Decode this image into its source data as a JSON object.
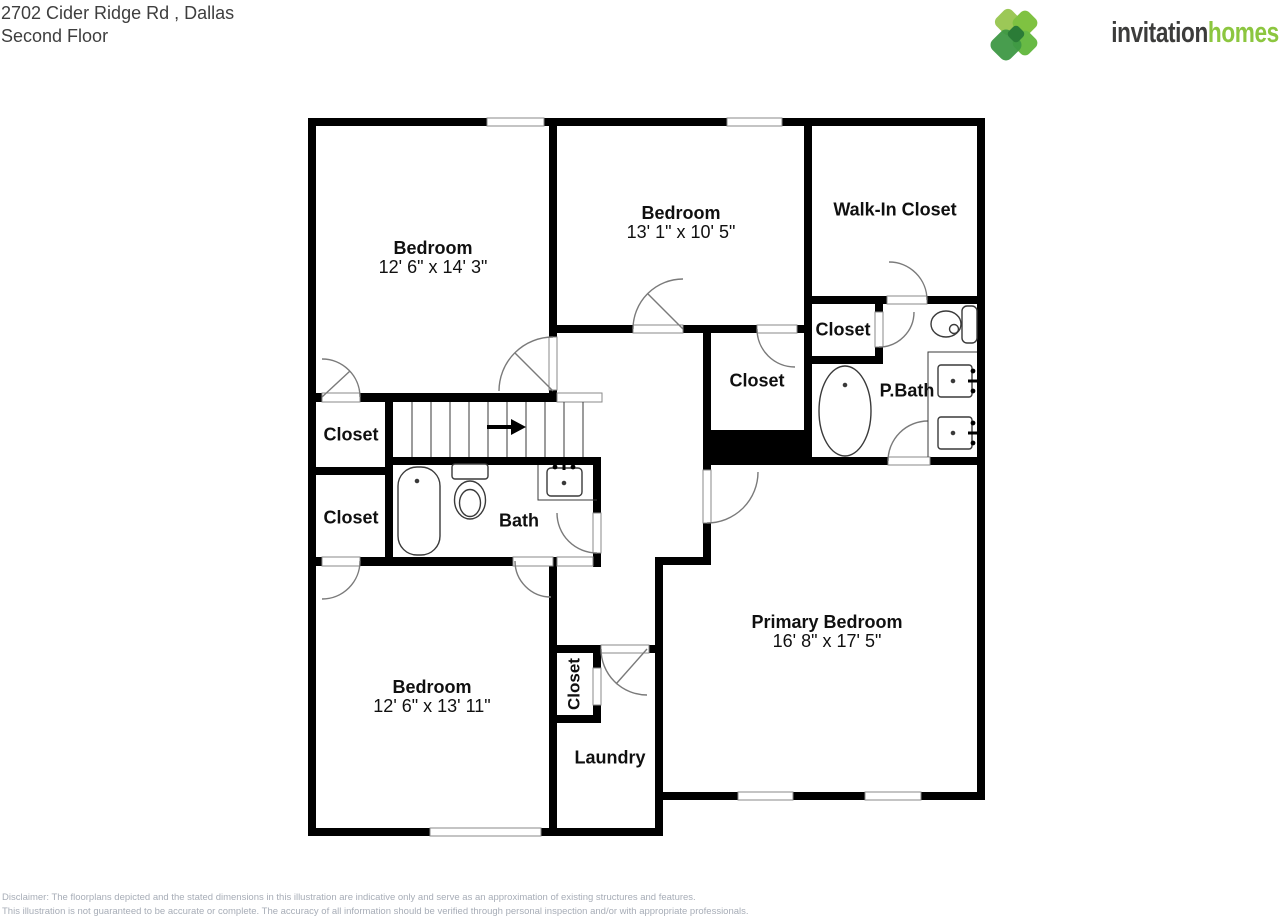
{
  "header": {
    "address": "2702 Cider Ridge Rd , Dallas",
    "floor": "Second Floor"
  },
  "logo": {
    "brand_word_dark": "invitation",
    "brand_word_green": "homes",
    "icon": "pinwheel-leaf-icon",
    "color_dark": "#3C3C3B",
    "color_green": "#8CC63F"
  },
  "floorplan": {
    "wall_color": "#000000",
    "stairs_arrow_direction": "right",
    "rooms": {
      "bedroom_top_left": {
        "name": "Bedroom",
        "dims": "12' 6\" x 14' 3\""
      },
      "bedroom_top_middle": {
        "name": "Bedroom",
        "dims": "13' 1\" x 10' 5\""
      },
      "walk_in_closet": {
        "name": "Walk-In Closet"
      },
      "closet_by_pbath": {
        "name": "Closet"
      },
      "pbath": {
        "name": "P.Bath"
      },
      "closet_hall": {
        "name": "Closet"
      },
      "closet_left_upper": {
        "name": "Closet"
      },
      "closet_left_lower": {
        "name": "Closet"
      },
      "bath": {
        "name": "Bath"
      },
      "bedroom_bottom_left": {
        "name": "Bedroom",
        "dims": "12' 6\" x 13' 11\""
      },
      "closet_laundry": {
        "name": "Closet"
      },
      "laundry": {
        "name": "Laundry"
      },
      "primary_bedroom": {
        "name": "Primary Bedroom",
        "dims": "16' 8\" x 17' 5\""
      }
    }
  },
  "disclaimer": {
    "line1": "Disclaimer: The floorplans depicted and the stated dimensions in this illustration are indicative only and serve as an approximation of existing structures and features.",
    "line2": "This illustration is not guaranteed to be accurate or complete. The accuracy of all information should be verified through personal inspection and/or with appropriate professionals."
  }
}
